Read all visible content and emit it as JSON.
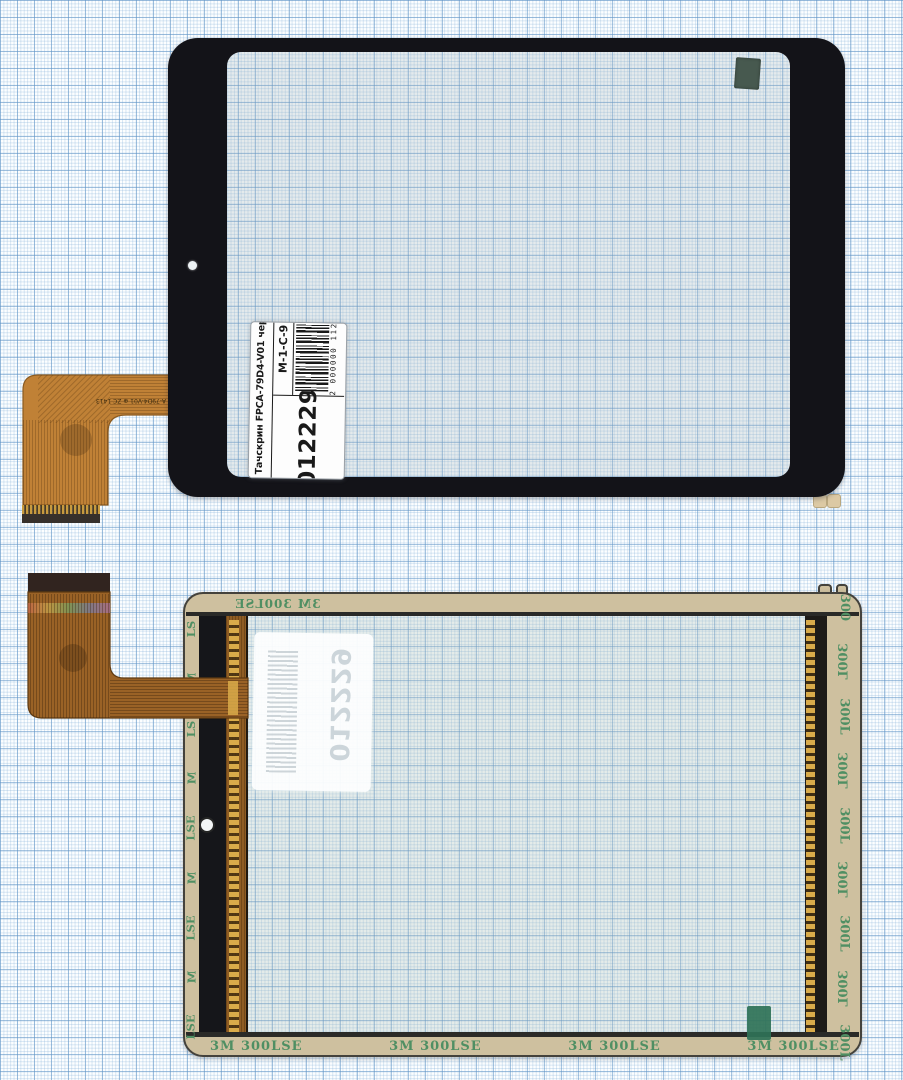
{
  "scene": {
    "subject": "Tablet touchscreen digitizer, front and back views, on millimeter graph paper"
  },
  "label": {
    "title": "Тачскрин FPCA-79D4-V01 черный",
    "sku": "012229",
    "grade": "M-1-C-9",
    "barcode_digits": "2 000000 112398"
  },
  "ghost_label": {
    "sku": "012229"
  },
  "cable_marking": "A-79D4-V01 ⊕ ZC 1413",
  "tape": {
    "top_text": "3M 300LSE",
    "bottom_texts": [
      "3M 300LSE",
      "3M 300LSE",
      "3M 300LSE",
      "3M 300LSE"
    ],
    "right_texts": [
      "300",
      "300L",
      "300L",
      "300L",
      "300L",
      "300L",
      "300L",
      "300L",
      "300L"
    ],
    "left_texts": [
      "LS",
      "M",
      "LS",
      "M",
      "LSE",
      "M",
      "LSE",
      "M",
      "LSE"
    ]
  },
  "colors": {
    "paper_bg": "#fcfeff",
    "grid_minor": "#cfe0ee",
    "grid_major": "#6094c6",
    "panel_black": "#131318",
    "flex_copper_front": "#c08136",
    "flex_copper_back": "#9a6226",
    "tape_tan": "#cec09f",
    "tape_text_green": "#4f8f63",
    "tab_green": "#2f7257",
    "gold_contacts": "#d9ab4a"
  }
}
